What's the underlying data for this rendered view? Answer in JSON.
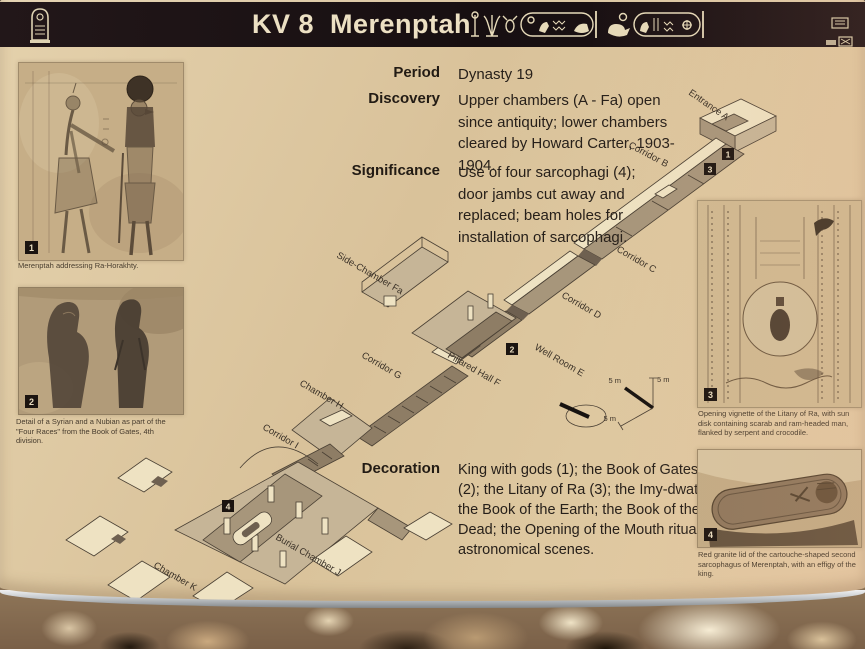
{
  "header": {
    "title": "KV 8  Merenptah"
  },
  "info_rows": [
    {
      "label": "Period",
      "text": "Dynasty 19"
    },
    {
      "label": "Discovery",
      "text": "Upper chambers (A - Fa) open since antiquity; lower chambers cleared by Howard Carter, 1903-1904."
    },
    {
      "label": "Significance",
      "text": "Use of four sarcophagi (4); door jambs cut away and replaced; beam holes for installation of sarcophagi."
    },
    {
      "label": "Decoration",
      "text": "King with gods (1); the Book of Gates (2); the Litany of Ra (3); the Imy-dwat; the Book of the Earth; the Book of the Dead; the Opening of the Mouth ritual; astronomical scenes."
    }
  ],
  "figures": [
    {
      "number": "1",
      "caption": "Merenptah addressing Ra-Horakhty."
    },
    {
      "number": "2",
      "caption": "Detail of a Syrian and a Nubian as part of the \"Four Races\" from the Book of Gates, 4th division."
    },
    {
      "number": "3",
      "caption": "Opening vignette of the Litany of Ra, with sun disk containing scarab and ram-headed man, flanked by serpent and crocodile."
    },
    {
      "number": "4",
      "caption": "Red granite lid of the cartouche-shaped second sarcophagus of Merenptah, with an effigy of the king."
    }
  ],
  "diagram": {
    "labels": {
      "entrance_a": "Entrance A",
      "corridor_b": "Corridor B",
      "corridor_c": "Corridor C",
      "corridor_d": "Corridor D",
      "well_room_e": "Well Room E",
      "pillared_hall_f": "Pillared Hall F",
      "side_chamber_fa": "Side-Chamber Fa",
      "corridor_g": "Corridor G",
      "chamber_h": "Chamber H",
      "corridor_i": "Corridor I",
      "burial_chamber_j": "Burial Chamber J",
      "chamber_k": "Chamber K"
    },
    "markers": {
      "m1": "1",
      "m2": "2",
      "m3": "3",
      "m4": "4"
    },
    "scale_label": "5 m"
  },
  "colors": {
    "sign_background": "#d9c29a",
    "header_background": "#170f11",
    "header_text": "#ece0c3",
    "badge_background": "#1b1410",
    "ink": "#27201a"
  }
}
